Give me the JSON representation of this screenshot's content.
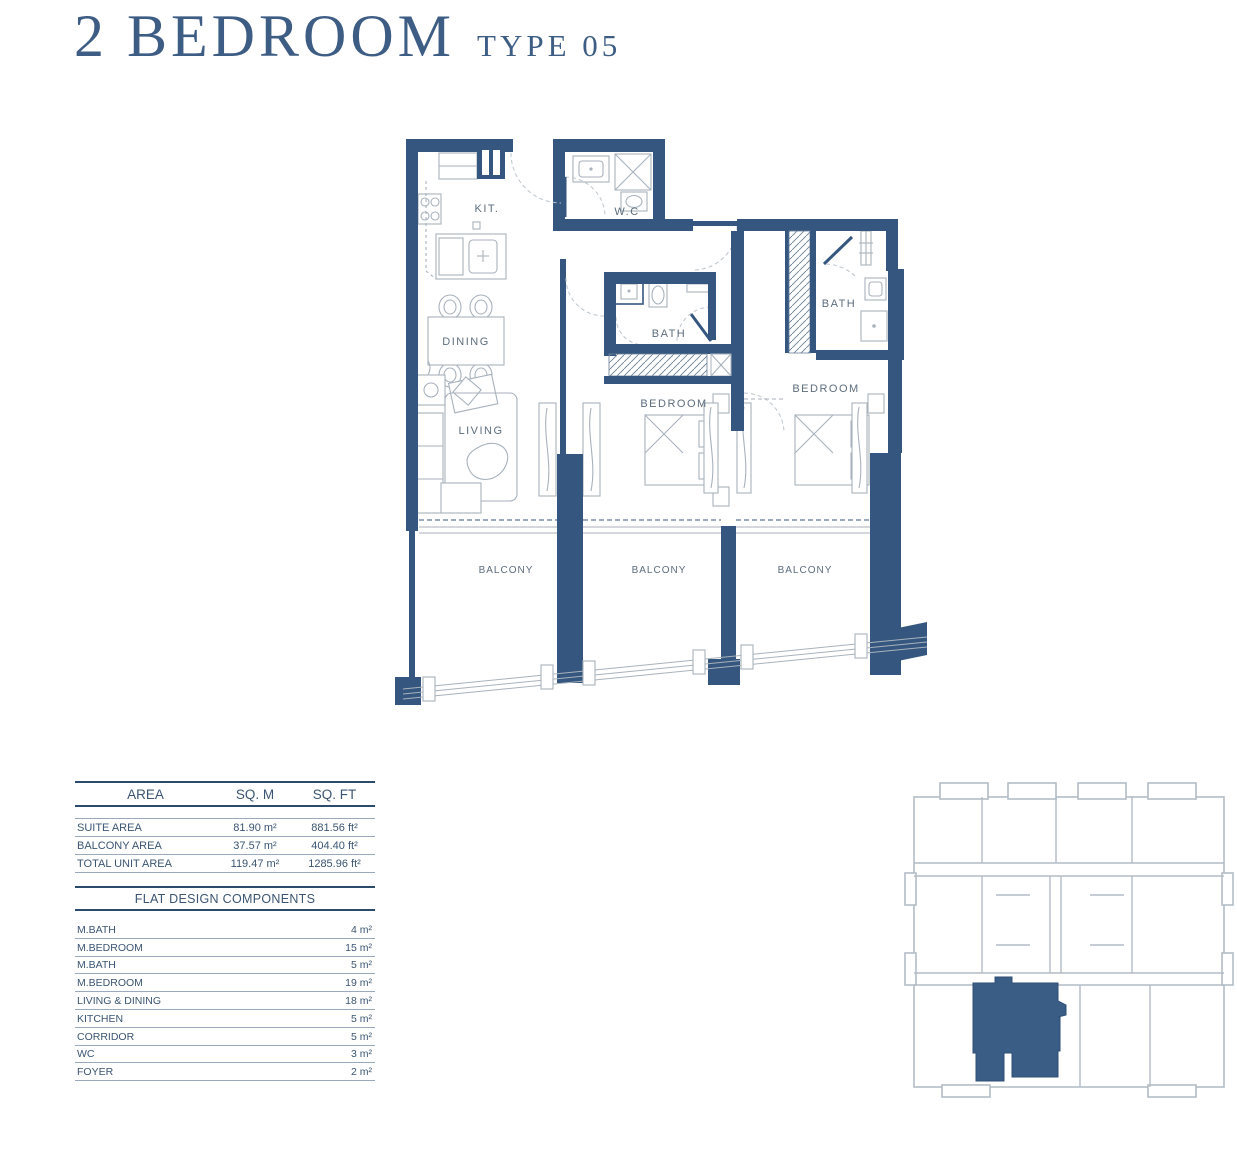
{
  "title": {
    "main": "2 BEDROOM",
    "type_label": "TYPE 05"
  },
  "plan": {
    "rooms": {
      "kit": "KIT.",
      "wc": "W.C",
      "dining": "DINING",
      "living": "LIVING",
      "bath_middle": "BATH",
      "bath_right": "BATH",
      "bedroom_middle": "BEDROOM",
      "bedroom_right": "BEDROOM",
      "balcony_left": "BALCONY",
      "balcony_middle": "BALCONY",
      "balcony_right": "BALCONY"
    }
  },
  "area_table": {
    "headers": [
      "AREA",
      "SQ. M",
      "SQ. FT"
    ],
    "rows": [
      {
        "label": "SUITE AREA",
        "sqm": "81.90  m²",
        "sqft": "881.56  ft²"
      },
      {
        "label": "BALCONY AREA",
        "sqm": "37.57  m²",
        "sqft": "404.40 ft²"
      },
      {
        "label": "TOTAL UNIT AREA",
        "sqm": "119.47  m²",
        "sqft": "1285.96 ft²"
      }
    ]
  },
  "components_table": {
    "title": "FLAT DESIGN COMPONENTS",
    "rows": [
      {
        "label": "M.BATH",
        "value": "4 m²"
      },
      {
        "label": "M.BEDROOM",
        "value": "15 m²"
      },
      {
        "label": "M.BATH",
        "value": "5 m²"
      },
      {
        "label": "M.BEDROOM",
        "value": "19 m²"
      },
      {
        "label": "LIVING & DINING",
        "value": "18 m²"
      },
      {
        "label": "KITCHEN",
        "value": "5 m²"
      },
      {
        "label": "CORRIDOR",
        "value": "5 m²"
      },
      {
        "label": "WC",
        "value": "3 m²"
      },
      {
        "label": "FOYER",
        "value": "2 m²"
      }
    ]
  },
  "colors": {
    "wall": "#35577F",
    "accent": "#3E5D84",
    "room_label": "#5D6D7D",
    "table_text": "#3B5572",
    "fixture_line": "#A8B2BC",
    "keyplan_outline": "#B3BCC6"
  }
}
